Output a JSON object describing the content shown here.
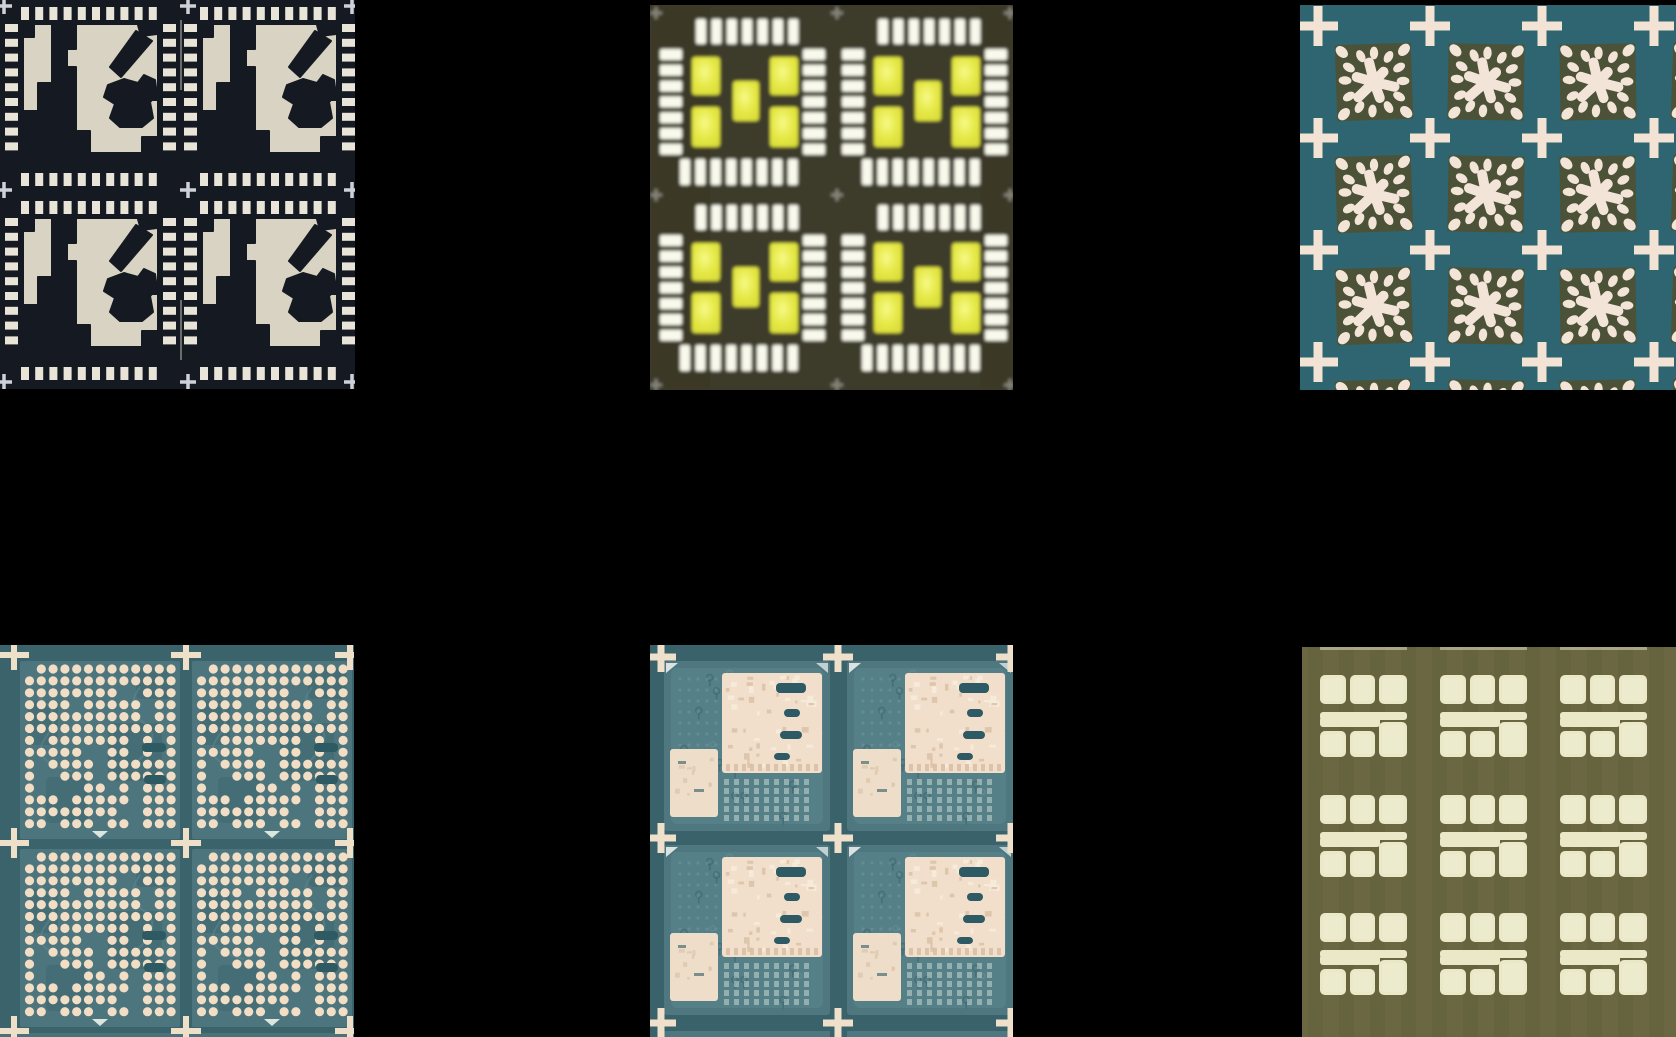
{
  "figure": {
    "background": "#000000",
    "canvas": {
      "width": 1676,
      "height": 1037
    },
    "panels": [
      {
        "id": "qfn-leadframe",
        "type": "leadframe",
        "description": "Dark navy QFN leadframe panel, 2x2 units of cream die-pad islands surrounded by perimeter lead tick marks, gray plus fiducials",
        "x": 0,
        "y": 0,
        "width": 355,
        "height": 389,
        "units": {
          "rows": 2,
          "cols": 2
        },
        "colors": {
          "bg": "#151922",
          "pad": "#d8d3c2",
          "tick": "#e8e4d8",
          "fiducial": "#ced1d7"
        }
      },
      {
        "id": "yellow-pad-units",
        "type": "blurYellow",
        "description": "Blurry dark-olive panel, 2x2 units each with white perimeter pads and five yellow squares in a quincunx pattern",
        "x": 650,
        "y": 5,
        "width": 363,
        "height": 385,
        "units": {
          "rows": 2,
          "cols": 2
        },
        "colors": {
          "bg": "#3e3b2b",
          "tick": "#f9f9ec",
          "yellow": "#e4e743",
          "yellowHi": "#f7fa86",
          "yellowLo": "#d8db39",
          "fiducial": "#a8a89c"
        }
      },
      {
        "id": "splat-etch-grid",
        "type": "splat",
        "description": "Teal panel with grid of dark-olive cells each containing a cream splat-shaped etch pattern, cream plus fiducials at every intersection",
        "x": 1300,
        "y": 5,
        "width": 376,
        "height": 385,
        "units": {
          "rows": 3,
          "cols": 3
        },
        "colors": {
          "bg": "#2e6570",
          "cell": "#4b5237",
          "splat": "#f3e4d8",
          "fiducial": "#f2e3d5"
        }
      },
      {
        "id": "bga-dot-substrate",
        "type": "bga",
        "description": "Teal substrate panel, 2x2 units filled with grids of cream BGA ball pads with patterned gaps, dark slots and cream plus fiducials",
        "x": 0,
        "y": 645,
        "width": 354,
        "height": 392,
        "units": {
          "rows": 2,
          "cols": 2
        },
        "dots": {
          "cols": 13,
          "rows": 14,
          "skip": 0.26,
          "edgeSkip": 0.06
        },
        "colors": {
          "bg": "#3a636c",
          "unit": "#4d757d",
          "patch": "#426b73",
          "dot": "#f2ddc5",
          "slot": "#2e5a63",
          "trace": "#5f8890",
          "fiducial": "#eedfc9",
          "marker": "#dce6df"
        }
      },
      {
        "id": "copper-trace-substrate",
        "type": "substrate",
        "description": "Teal PCB substrate panel, 2x2 units each with a large mottled copper pad array square, a smaller copper rectangle, ghost traces and cream plus fiducials",
        "x": 650,
        "y": 645,
        "width": 363,
        "height": 392,
        "units": {
          "rows": 2,
          "cols": 2
        },
        "colors": {
          "bg": "#3a626b",
          "unit": "#4f777f",
          "inner": "#57818a",
          "ghost": "#36606a",
          "ghostLight": "#70989f",
          "copper": "#f1dfcb",
          "copperDark": "#d9bfa4",
          "copperHi": "#f8eedd",
          "slot": "#2d5a64",
          "pad": "#dfe8e2",
          "small": "#eeddc9",
          "fiducial": "#efe0cb",
          "wedge": "#f2f6f2"
        }
      },
      {
        "id": "olive-pad-groups",
        "type": "padGroups",
        "description": "Olive ceramic panel with 3x3 groups of cream rounded pads: three squares, a stepped bar, and three squares per group, faint vertical stripes",
        "x": 1302,
        "y": 647,
        "width": 374,
        "height": 390,
        "units": {
          "rows": 3,
          "cols": 3
        },
        "colors": {
          "bg": "#6b6743",
          "stripe": "#5e5b3a",
          "pad": "#ebe8c8",
          "padHi": "#f3f1da"
        }
      }
    ]
  }
}
